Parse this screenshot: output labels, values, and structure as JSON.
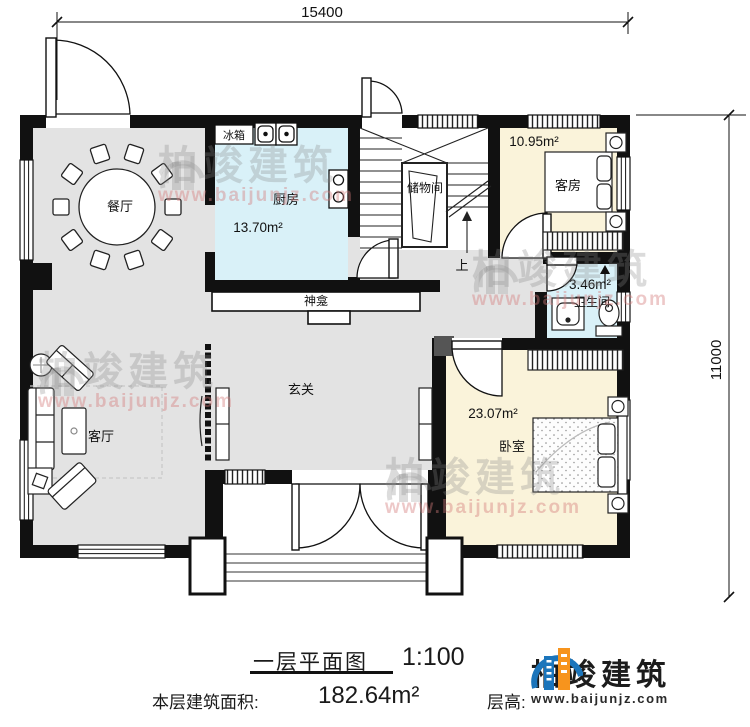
{
  "dimensions": {
    "width_mm": "15400",
    "height_mm": "11000"
  },
  "rooms": {
    "dining": {
      "label": "餐厅"
    },
    "kitchen": {
      "label": "厨房",
      "area": "13.70m²"
    },
    "storage": {
      "label": "储物间"
    },
    "guest": {
      "label": "客房",
      "area": "10.95m²"
    },
    "bath": {
      "label": "卫生间",
      "area": "3.46m²"
    },
    "bedroom": {
      "label": "卧室",
      "area": "23.07m²"
    },
    "living": {
      "label": "客厅"
    },
    "foyer": {
      "label": "玄关"
    },
    "shrine": {
      "label": "神龛"
    },
    "fridge": {
      "label": "冰箱"
    },
    "stairs": {
      "up_label": "上"
    }
  },
  "title_block": {
    "title": "一层平面图",
    "scale": "1:100",
    "floor_area_label": "本层建筑面积:",
    "floor_area_value": "182.64m²",
    "floor_height_label": "层高:",
    "floor_height_value": "3.6m"
  },
  "brand": {
    "name": "柏竣建筑",
    "website": "www.baijunjz.com"
  },
  "watermark": {
    "name": "柏竣建筑",
    "website": "www.baijunjz.com"
  },
  "colors": {
    "wall": "#111111",
    "floor_gray": "#e3e3e3",
    "floor_cyan": "#d9f1f8",
    "floor_cream": "#faf3da",
    "brand_blue": "#1b75bb",
    "brand_orange": "#f7941d"
  }
}
